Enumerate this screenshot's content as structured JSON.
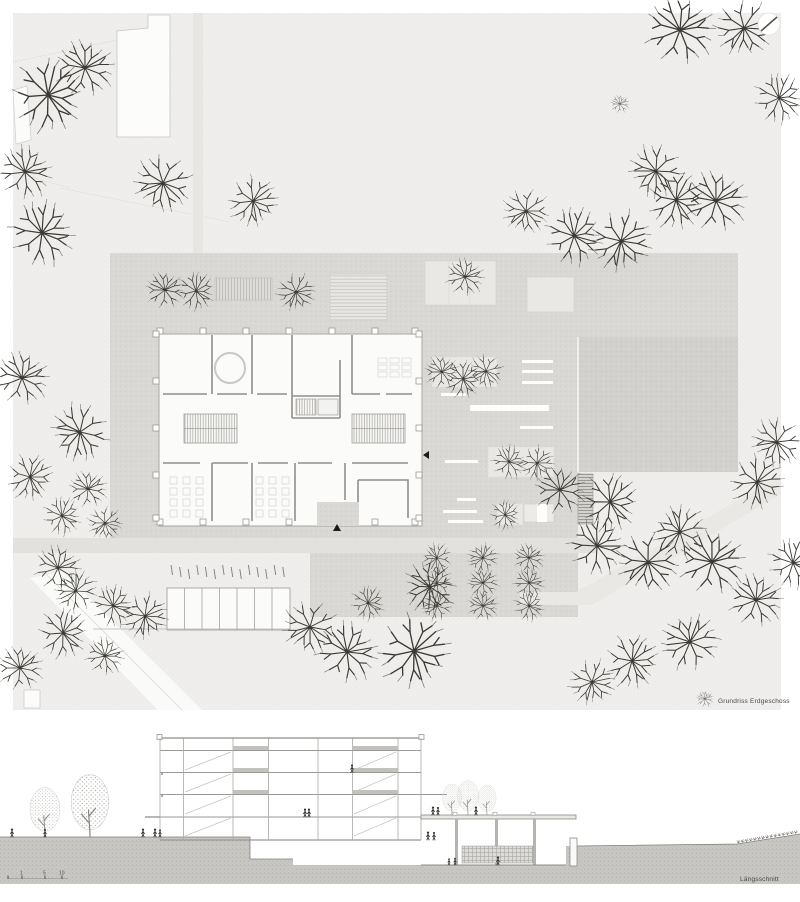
{
  "sheet": {
    "type": "architectural drawing sheet",
    "drawings": [
      "ground floor site plan",
      "longitudinal section"
    ]
  },
  "site_plan": {
    "label": "Grundriss Erdgeschoss"
  },
  "section": {
    "label": "Längsschnitt",
    "scale_labels": [
      "1",
      "5",
      "10"
    ]
  },
  "icons": {
    "north_arrow": "north-arrow-icon",
    "entrance_marker": "entrance-arrow-icon",
    "tree": "tree-icon",
    "person": "person-figure-icon"
  },
  "colors": {
    "paper": "#ffffff",
    "site_ground": "#efeeec",
    "plaza": "#d9d8d4",
    "plaza_dark": "#d2d1cd",
    "street": "#e2e1de",
    "building_fill": "#fbfbfa",
    "wall_line": "#908f8b",
    "section_ground": "#c9c8c4",
    "tree_stroke": "#3a3934",
    "label_text": "#4a4946"
  }
}
